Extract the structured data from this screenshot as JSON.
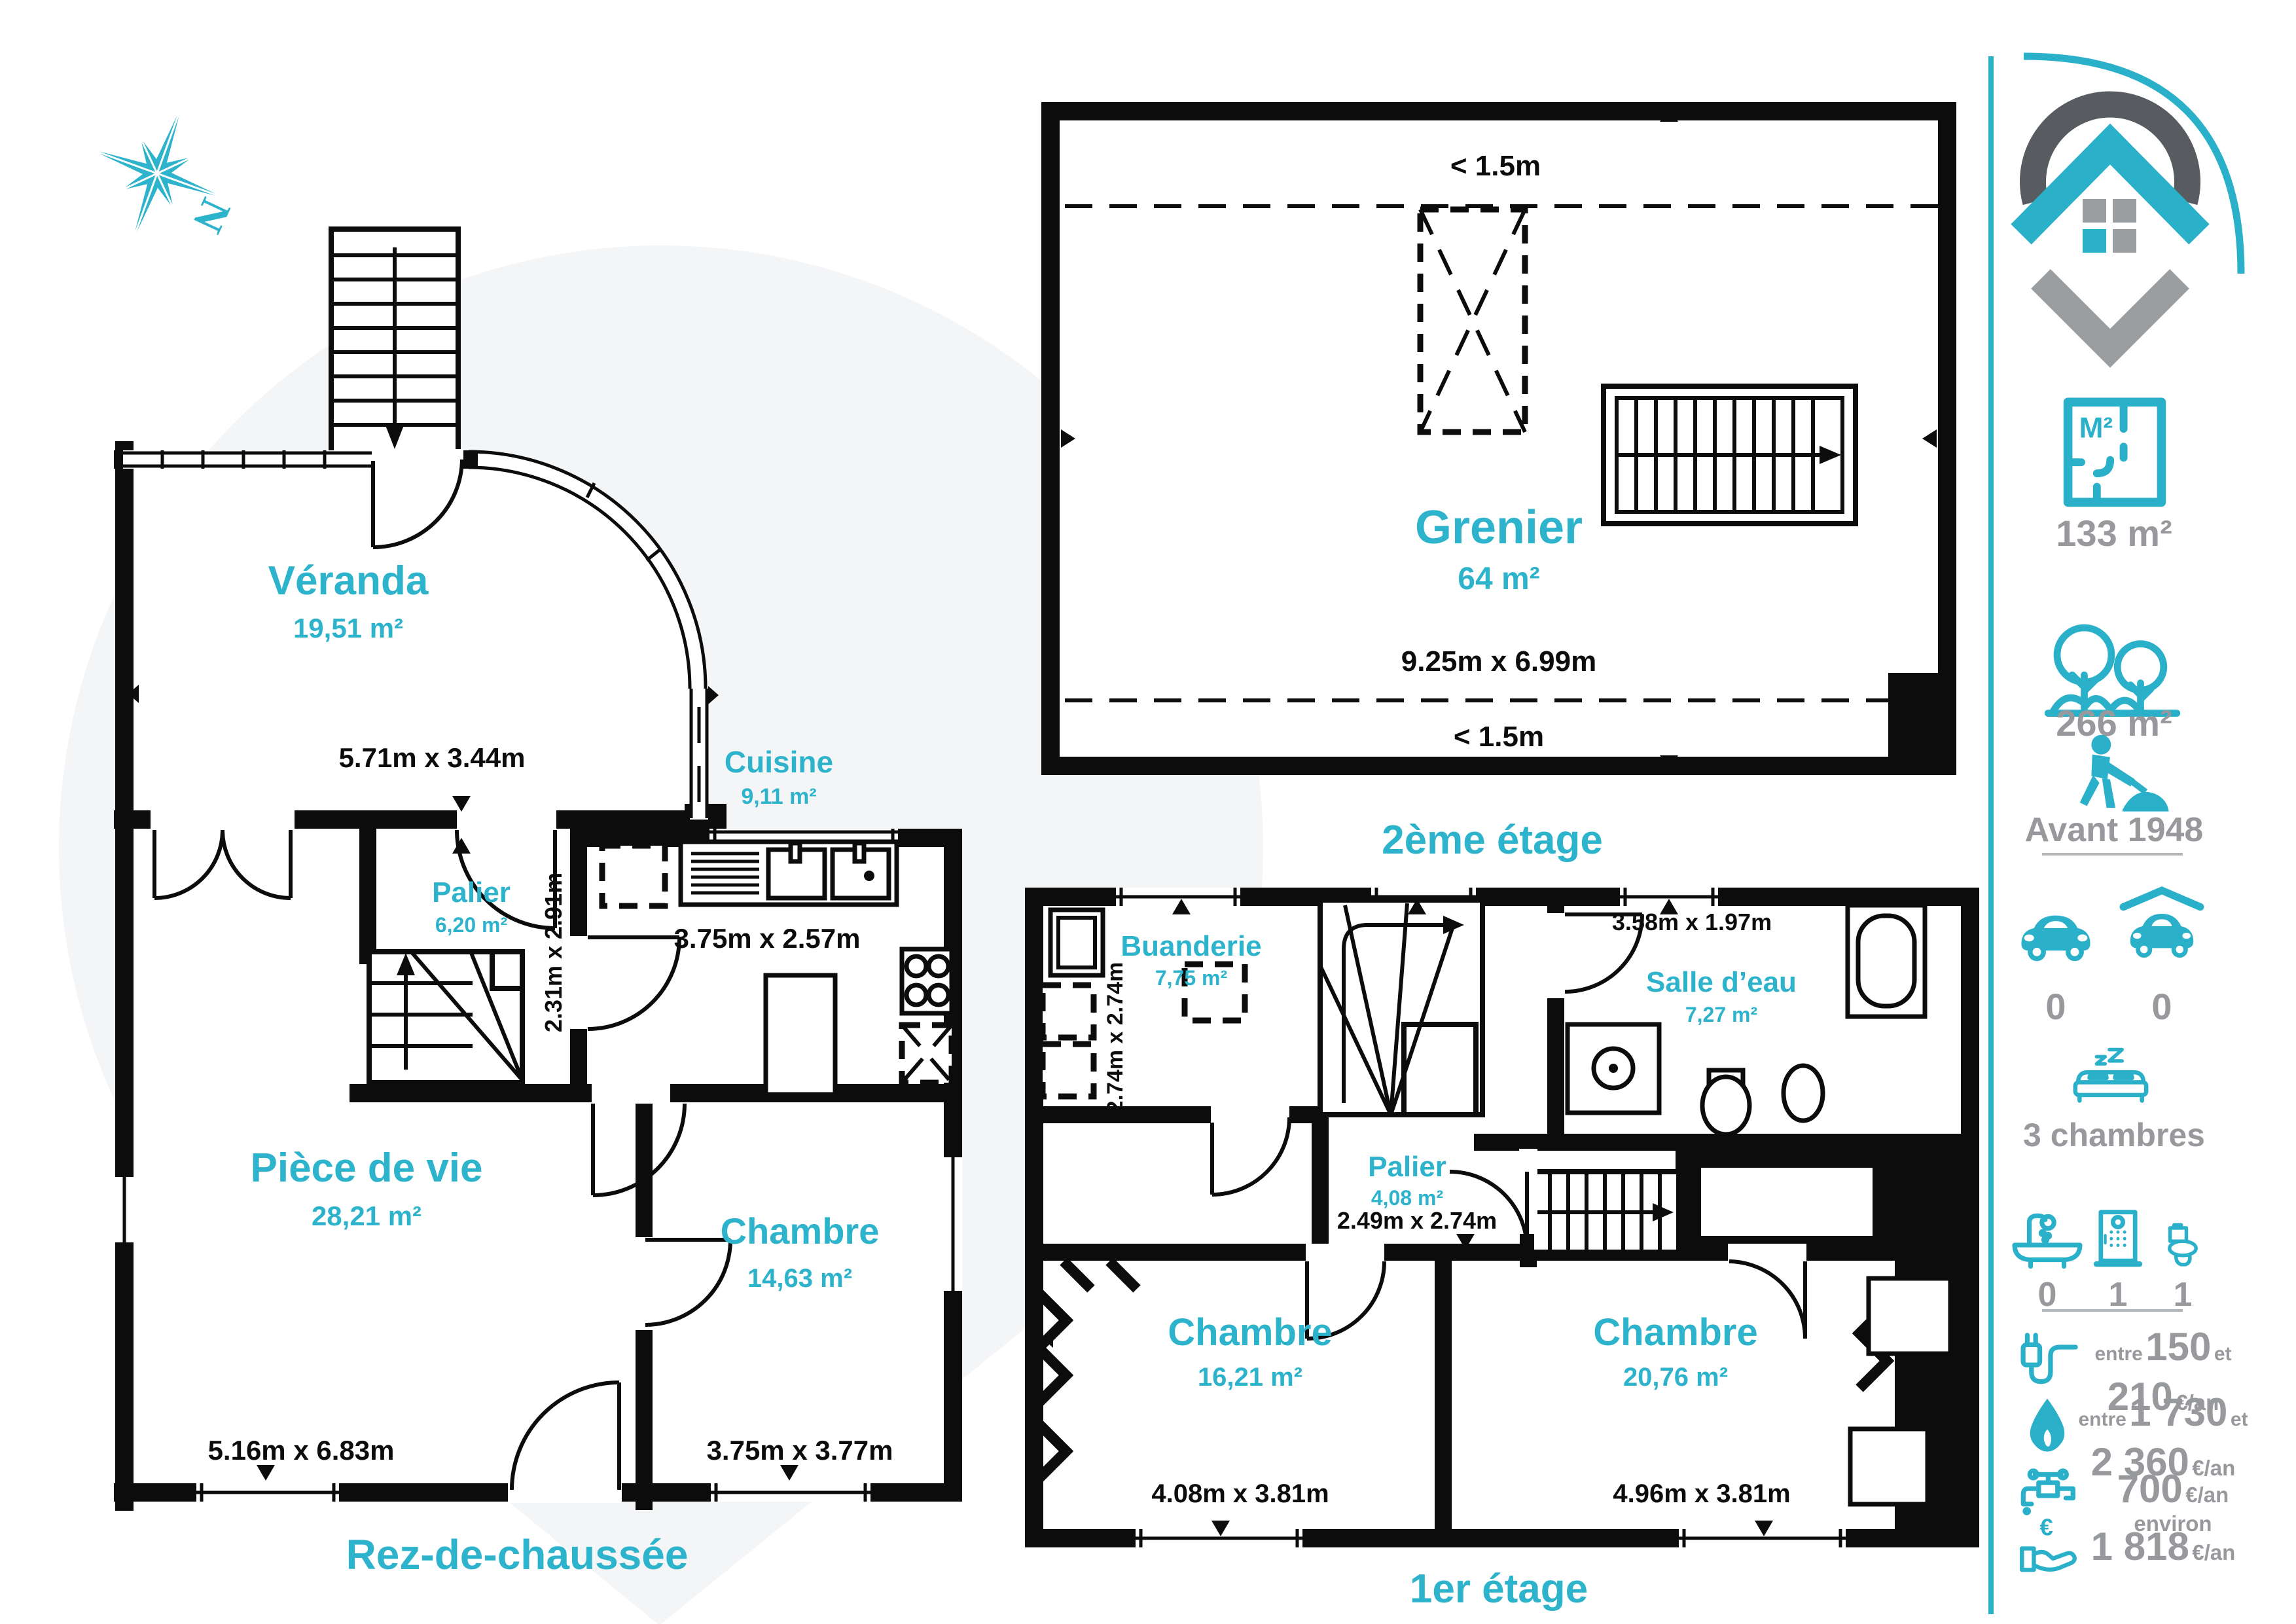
{
  "accent_color": "#2db3cb",
  "wall_color": "#0c0c0c",
  "gray_text_color": "#97999c",
  "compass": {
    "label": "N"
  },
  "floors": {
    "rdc": {
      "label": "Rez-de-chaussée",
      "rooms": {
        "veranda": {
          "name": "Véranda",
          "area": "19,51 m²",
          "dims": "5.71m x 3.44m"
        },
        "palier": {
          "name": "Palier",
          "area": "6,20 m²",
          "dims": "2.31m x 2.91m"
        },
        "cuisine": {
          "name": "Cuisine",
          "area": "9,11 m²",
          "dims": "3.75m x 2.57m"
        },
        "piece_de_vie": {
          "name": "Pièce de vie",
          "area": "28,21 m²",
          "dims": "5.16m x 6.83m"
        },
        "chambre": {
          "name": "Chambre",
          "area": "14,63 m²",
          "dims": "3.75m x 3.77m"
        }
      }
    },
    "etage1": {
      "label": "1er étage",
      "rooms": {
        "buanderie": {
          "name": "Buanderie",
          "area": "7,75 m²",
          "dims": "2.74m x 2.74m"
        },
        "palier": {
          "name": "Palier",
          "area": "4,08 m²",
          "dims": "2.49m x 2.74m"
        },
        "salle_deau": {
          "name": "Salle d’eau",
          "area": "7,27 m²",
          "dims": "3.58m x 1.97m"
        },
        "chambre1": {
          "name": "Chambre",
          "area": "16,21 m²",
          "dims": "4.08m x 3.81m"
        },
        "chambre2": {
          "name": "Chambre",
          "area": "20,76 m²",
          "dims": "4.96m x 3.81m"
        }
      }
    },
    "etage2": {
      "label": "2ème étage",
      "rooms": {
        "grenier": {
          "name": "Grenier",
          "area": "64 m²",
          "dims": "9.25m x 6.99m"
        }
      },
      "height_note_top": "< 1.5m",
      "height_note_bottom": "< 1.5m"
    }
  },
  "sidebar": {
    "living_area": "133 m²",
    "land_area": "266 m²",
    "construction_period": "Avant 1948",
    "parking_spots": "0",
    "garage_spots": "0",
    "bedrooms": "3 chambres",
    "bathtubs": "0",
    "showers": "1",
    "toilets": "1",
    "electricity": {
      "w1": "entre",
      "v1": "150",
      "w2": "et",
      "v2": "210",
      "unit": "€/an"
    },
    "gas": {
      "w1": "entre",
      "v1": "1 730",
      "w2": "et",
      "v2": "2 360",
      "unit": "€/an"
    },
    "water": {
      "value": "700",
      "unit": "€/an environ"
    },
    "tax": {
      "value": "1 818",
      "unit": "€/an"
    }
  }
}
